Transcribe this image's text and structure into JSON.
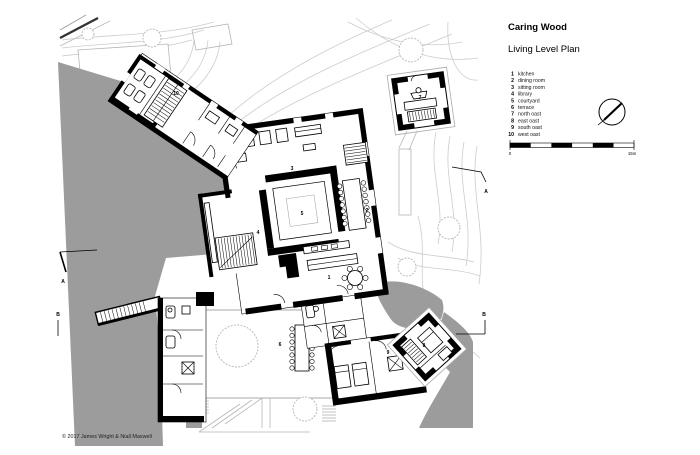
{
  "title_block": {
    "title": "Caring Wood",
    "subtitle": "Living Level Plan"
  },
  "legend": {
    "items": [
      {
        "num": "1",
        "label": "kitchen"
      },
      {
        "num": "2",
        "label": "dining room"
      },
      {
        "num": "3",
        "label": "sitting room"
      },
      {
        "num": "4",
        "label": "library"
      },
      {
        "num": "5",
        "label": "courtyard"
      },
      {
        "num": "6",
        "label": "terrace"
      },
      {
        "num": "7",
        "label": "north oast"
      },
      {
        "num": "8",
        "label": "east oast"
      },
      {
        "num": "9",
        "label": "south oast"
      },
      {
        "num": "10",
        "label": "west oast"
      }
    ]
  },
  "plan": {
    "section_marker_a": "A",
    "section_marker_b": "B"
  },
  "scale_bar": {
    "start_label": "0",
    "end_label": "15m"
  },
  "footer": {
    "copyright": "© 2017 James Wright & Niall Maxwell"
  },
  "colors": {
    "landscape_gray": "#9c9c9c",
    "contour_gray": "#cccccc",
    "light_outline": "#b5b5b5",
    "wall_black": "#000000"
  }
}
